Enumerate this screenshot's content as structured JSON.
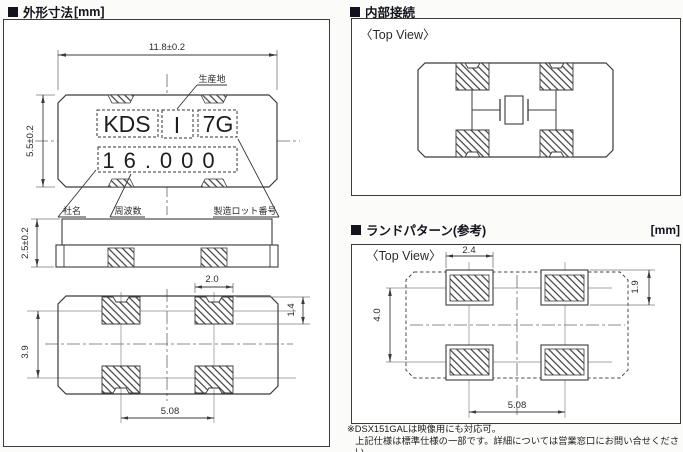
{
  "sections": {
    "outline": {
      "title": "外形寸法",
      "unit": "[mm]",
      "dims": {
        "body_width": "11.8±0.2",
        "body_height": "5.5±0.2",
        "thickness": "2.5±0.2",
        "pad_width": "2.0",
        "pad_height": "1.4",
        "pad_row_pitch": "3.9",
        "pad_col_pitch": "5.08"
      },
      "marking": {
        "company": "KDS",
        "origin_mark": "I",
        "lot": "7G",
        "frequency": "16.000"
      },
      "labels": {
        "origin": "生産地",
        "company": "社名",
        "frequency": "周波数",
        "lot": "製造ロット番号"
      }
    },
    "internal": {
      "title": "内部接続",
      "view": "〈Top View〉"
    },
    "land": {
      "title": "ランドパターン(参考)",
      "unit": "[mm]",
      "view": "〈Top View〉",
      "dims": {
        "land_width": "2.4",
        "land_height": "1.9",
        "row_pitch": "4.0",
        "col_pitch": "5.08"
      }
    },
    "footnote": {
      "line1": "※DSX151GALは映像用にも対応可。",
      "line2": "上記仕様は標準仕様の一部です。詳細については営業窓口にお問い合せください。"
    }
  }
}
